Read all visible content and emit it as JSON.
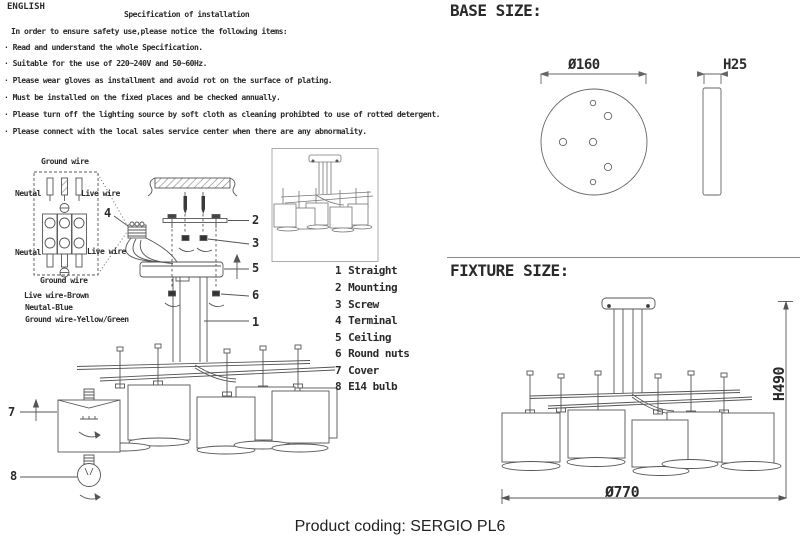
{
  "header": {
    "language": "ENGLISH"
  },
  "spec": {
    "title": "Specification of installation",
    "intro": "In order to ensure safety use,please notice the following items:",
    "bullet": "·",
    "items": [
      "Read and understand the whole Specification.",
      "Suitable for the use of 220~240V and 50~60Hz.",
      "Please wear gloves as installment and avoid rot on the surface of plating.",
      "Must be installed on the fixed places and be checked annually.",
      "Please turn off the lighting source by soft cloth as cleaning prohibted to use of rotted detergent.",
      "Please connect with the local sales service center when there are any abnormality."
    ]
  },
  "wiring": {
    "ground_top": "Ground wire",
    "neutral_top": "Neutal",
    "live_top": "Live wire",
    "neutral_bottom": "Neutal",
    "live_bottom": "Live wire",
    "ground_bottom": "Ground wire",
    "legend": [
      "Live wire-Brown",
      "Neutal-Blue",
      "Ground wire-Yellow/Green"
    ]
  },
  "callouts": {
    "straight": "1",
    "mounting": "2",
    "screw": "3",
    "terminal": "4",
    "ceiling": "5",
    "round_nuts": "6",
    "cover": "7",
    "bulb": "8"
  },
  "parts": [
    {
      "num": "1",
      "name": "Straight"
    },
    {
      "num": "2",
      "name": "Mounting"
    },
    {
      "num": "3",
      "name": "Screw"
    },
    {
      "num": "4",
      "name": "Terminal"
    },
    {
      "num": "5",
      "name": "Ceiling"
    },
    {
      "num": "6",
      "name": "Round nuts"
    },
    {
      "num": "7",
      "name": "Cover"
    },
    {
      "num": "8",
      "name": "E14 bulb"
    }
  ],
  "base_size": {
    "heading": "BASE SIZE:",
    "diameter": "Ø160",
    "thickness": "H25"
  },
  "fixture_size": {
    "heading": "FIXTURE SIZE:",
    "height": "H490",
    "diameter": "Ø770"
  },
  "footer": {
    "product_coding": "Product coding: SERGIO PL6"
  },
  "colors": {
    "ink": "#2a2a2a",
    "line": "#555555",
    "background": "#ffffff"
  }
}
